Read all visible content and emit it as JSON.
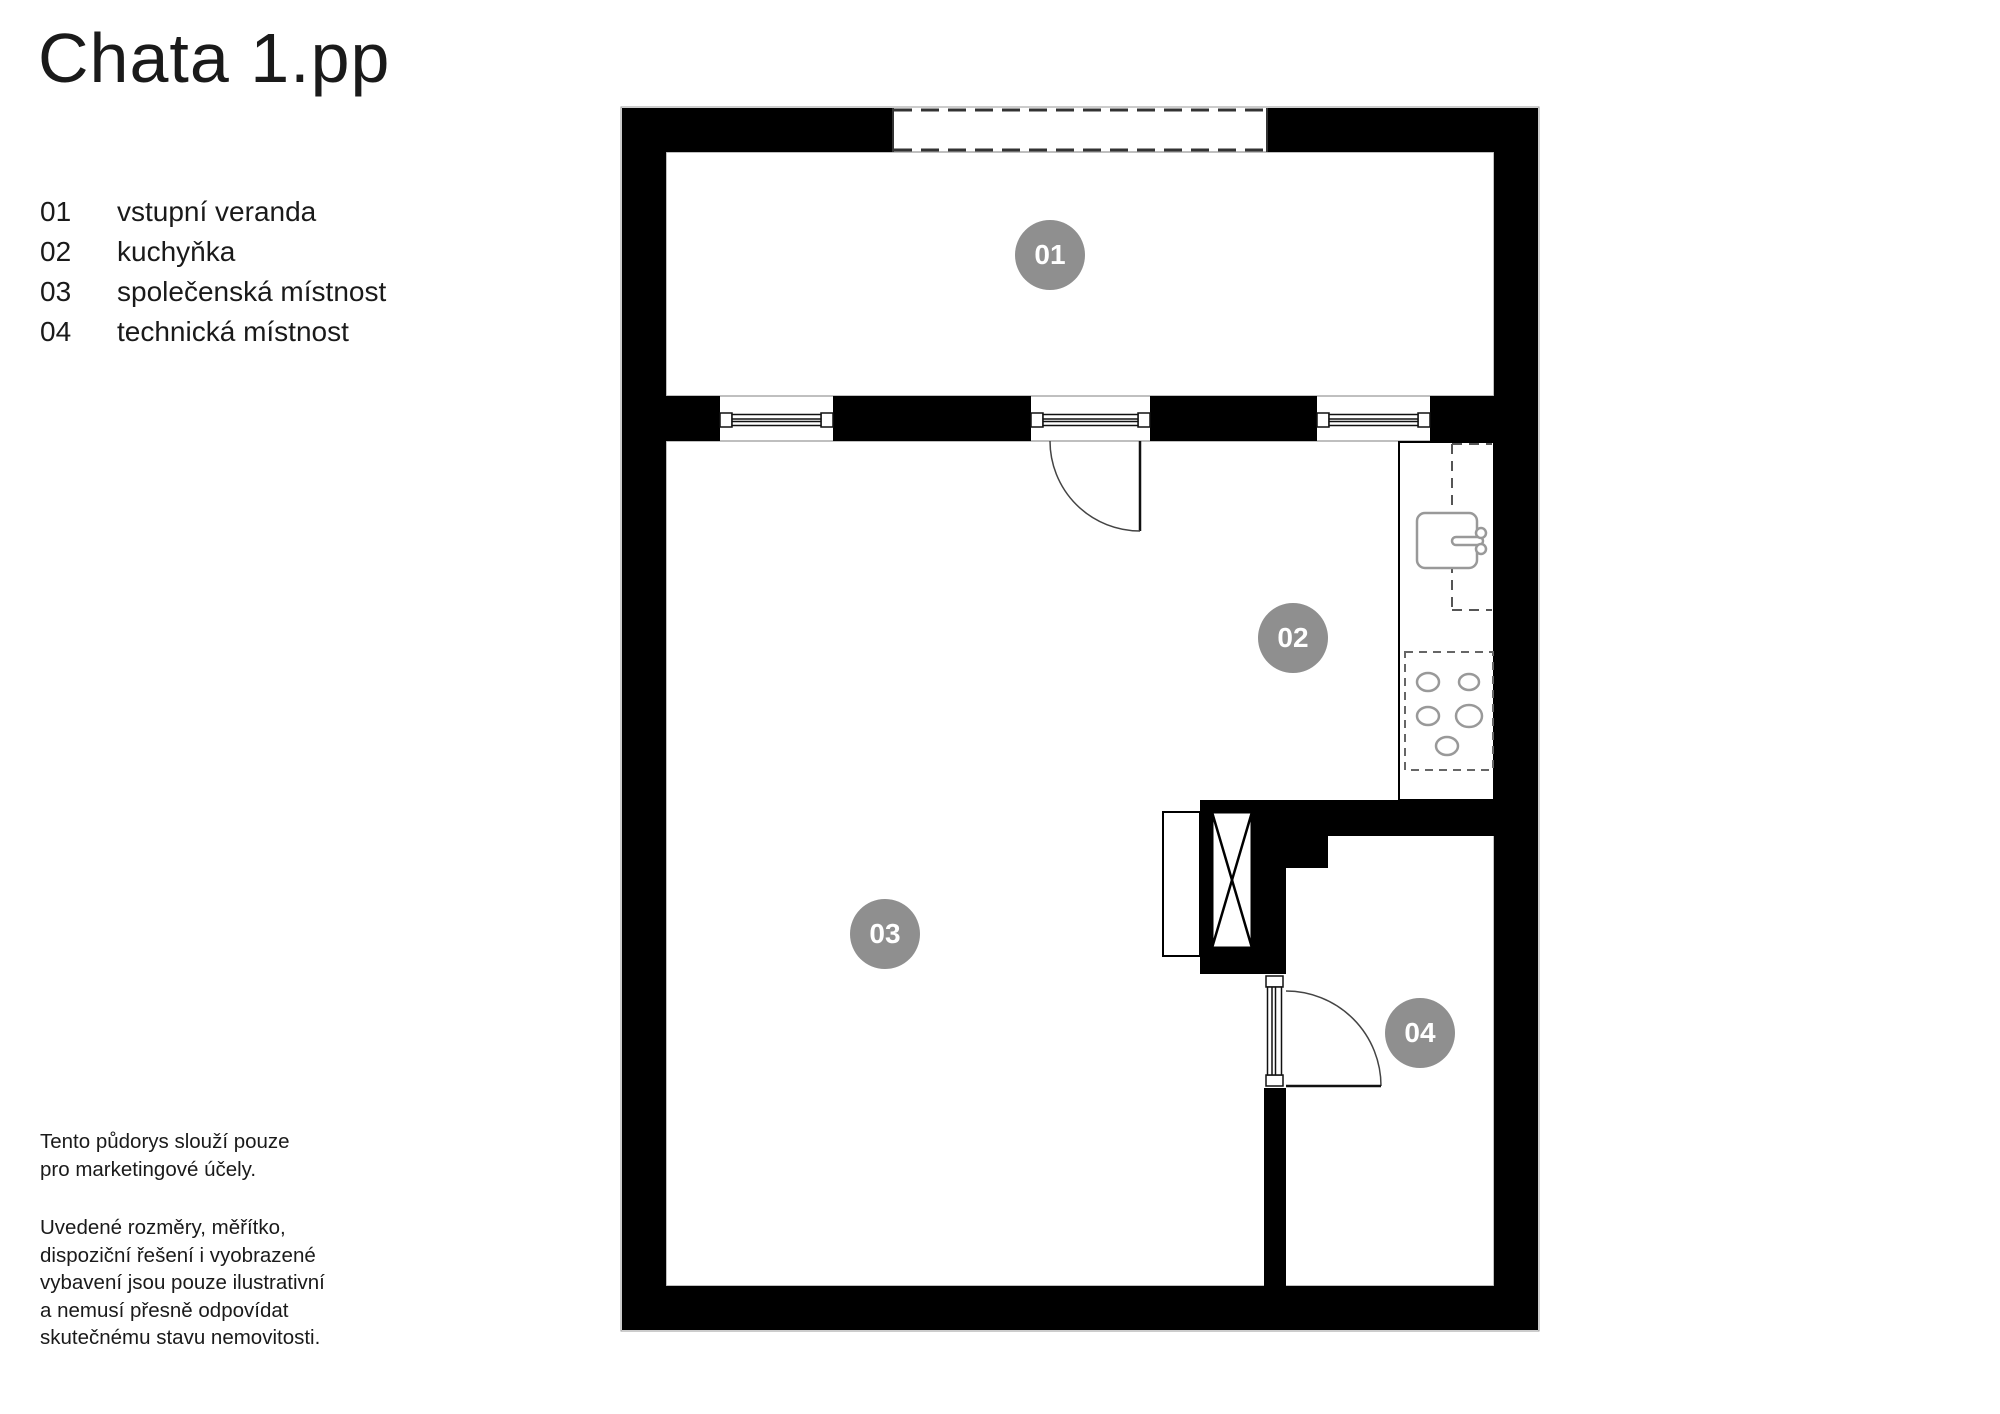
{
  "page": {
    "title": "Chata 1.pp"
  },
  "legend": {
    "items": [
      {
        "num": "01",
        "label": "vstupní veranda"
      },
      {
        "num": "02",
        "label": "kuchyňka"
      },
      {
        "num": "03",
        "label": "společenská místnost"
      },
      {
        "num": "04",
        "label": "technická místnost"
      }
    ]
  },
  "disclaimer": {
    "para1": [
      "Tento půdorys slouží pouze",
      "pro marketingové účely."
    ],
    "para2": [
      "Uvedené rozměry, měřítko,",
      "dispoziční řešení i vyobrazené",
      "vybavení jsou pouze ilustrativní",
      "a nemusí přesně odpovídat",
      "skutečnému stavu nemovitosti."
    ]
  },
  "colors": {
    "wall": "#000000",
    "badge": "#8f8f8f",
    "badge_text": "#ffffff",
    "text": "#1a1a1a"
  }
}
